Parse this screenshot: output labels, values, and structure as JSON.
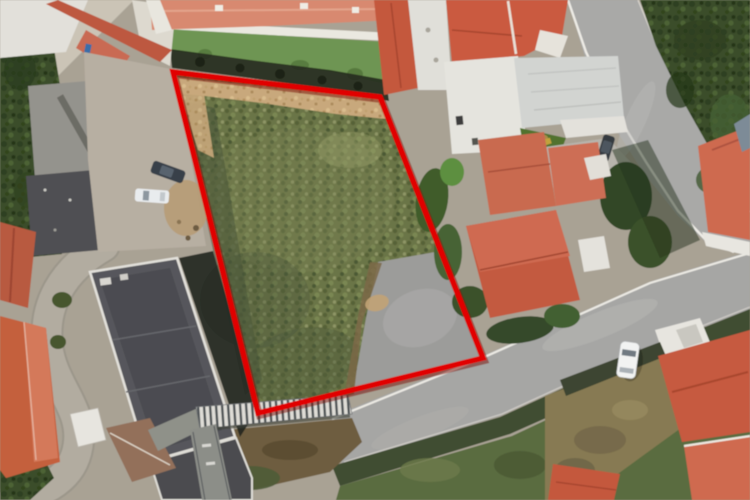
{
  "view": {
    "type": "satellite-aerial-photo",
    "width_px": 750,
    "height_px": 500,
    "description": "Aerial satellite photograph of a residential neighborhood; a vacant grassy land parcel in the center is outlined with a thick red quadrilateral overlay."
  },
  "overlay": {
    "shape": "quadrilateral",
    "stroke_color": "#e10202",
    "shadow_color": "#7a0d06",
    "stroke_width": 5.5,
    "points": [
      [
        173,
        72
      ],
      [
        380,
        97
      ],
      [
        483,
        358
      ],
      [
        258,
        413
      ]
    ]
  },
  "scene": {
    "parcel": [
      "dry-dirt-strip-top",
      "green-scrub-field",
      "paved-corner-bottom-right"
    ],
    "surroundings": [
      "terracotta-roof-houses",
      "white-warehouse-building",
      "dark-flat-roof-apartment-blocks",
      "parking-area-with-two-cars",
      "curving-streets",
      "dense-trees-top-right",
      "stair-ramp-below-parcel",
      "white-car-on-road",
      "dark-suv-near-house"
    ]
  },
  "colors": {
    "boundary": "#e10202",
    "field_green": "#6b7446",
    "dirt_tan": "#c8a87b",
    "road_gray": "#a6a6a4",
    "roof_terracotta": "#c75b41",
    "roof_salmon": "#d88970",
    "vegetation_dark": "#3b4d2b",
    "building_white": "#e5e4de",
    "apartment_roof": "#56575c",
    "shadow_dark": "#242a24"
  }
}
